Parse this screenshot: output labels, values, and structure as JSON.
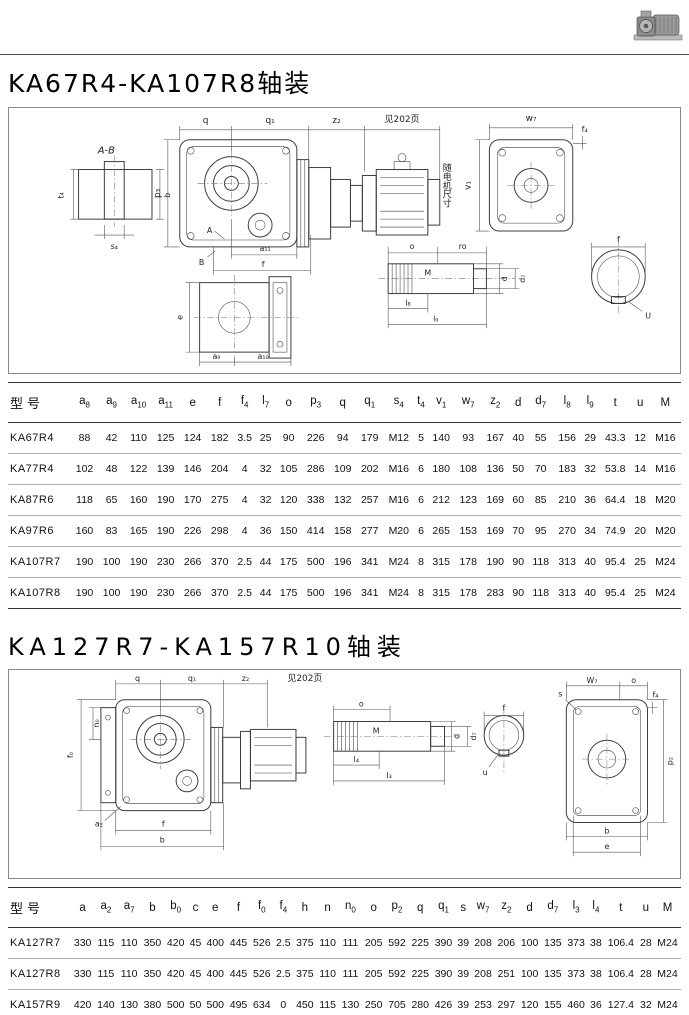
{
  "page": {
    "title1": "KA67R4-KA107R8轴装",
    "title2": "KA127R7-KA157R10轴装"
  },
  "figure1": {
    "labels": {
      "ab": "A-B",
      "t4": "t₄",
      "b": "b",
      "s4": "s₄",
      "q": "q",
      "q1": "q₁",
      "z2": "z₂",
      "see": "见202页",
      "p3": "p₃",
      "A": "A",
      "B": "B",
      "a11": "a₁₁",
      "f": "f",
      "motor_note": "随电机尺寸",
      "e": "e",
      "a9": "a₉",
      "a10": "a₁₀",
      "w7": "w₇",
      "f4": "f₄",
      "v1": "v₁",
      "o": "o",
      "ro": "ro",
      "M": "M",
      "d": "d",
      "d7": "d₇",
      "l8": "l₈",
      "l9": "l₉",
      "f_end": "f",
      "U": "U"
    }
  },
  "figure2": {
    "labels": {
      "q": "q",
      "q1": "q₁",
      "z2": "z₂",
      "see": "见202页",
      "f0": "f₀",
      "n0": "n₀",
      "a2": "a₂",
      "f": "f",
      "b": "b",
      "o": "o",
      "M": "M",
      "d": "d",
      "d7": "d₇",
      "l4": "l₄",
      "l3": "l₃",
      "f_end": "f",
      "u": "u",
      "W7": "W₇",
      "o2": "o",
      "s": "s",
      "f4": "f₄",
      "p2": "p₂",
      "b2": "b",
      "e": "e"
    }
  },
  "table1": {
    "headers": [
      "型号",
      "a_8",
      "a_9",
      "a_10",
      "a_11",
      "e",
      "f",
      "f_4",
      "l_7",
      "o",
      "p_3",
      "q",
      "q_1",
      "s_4",
      "t_4",
      "v_1",
      "w_7",
      "z_2",
      "d",
      "d_7",
      "l_8",
      "l_9",
      "t",
      "u",
      "M"
    ],
    "rows": [
      {
        "model": "KA67R4",
        "values": [
          "88",
          "42",
          "110",
          "125",
          "124",
          "182",
          "3.5",
          "25",
          "90",
          "226",
          "94",
          "179",
          "M12",
          "5",
          "140",
          "93",
          "167",
          "40",
          "55",
          "156",
          "29",
          "43.3",
          "12",
          "M16"
        ]
      },
      {
        "model": "KA77R4",
        "values": [
          "102",
          "48",
          "122",
          "139",
          "146",
          "204",
          "4",
          "32",
          "105",
          "286",
          "109",
          "202",
          "M16",
          "6",
          "180",
          "108",
          "136",
          "50",
          "70",
          "183",
          "32",
          "53.8",
          "14",
          "M16"
        ]
      },
      {
        "model": "KA87R6",
        "values": [
          "118",
          "65",
          "160",
          "190",
          "170",
          "275",
          "4",
          "32",
          "120",
          "338",
          "132",
          "257",
          "M16",
          "6",
          "212",
          "123",
          "169",
          "60",
          "85",
          "210",
          "36",
          "64.4",
          "18",
          "M20"
        ]
      },
      {
        "model": "KA97R6",
        "values": [
          "160",
          "83",
          "165",
          "190",
          "226",
          "298",
          "4",
          "36",
          "150",
          "414",
          "158",
          "277",
          "M20",
          "6",
          "265",
          "153",
          "169",
          "70",
          "95",
          "270",
          "34",
          "74.9",
          "20",
          "M20"
        ]
      },
      {
        "model": "KA107R7",
        "values": [
          "190",
          "100",
          "190",
          "230",
          "266",
          "370",
          "2.5",
          "44",
          "175",
          "500",
          "196",
          "341",
          "M24",
          "8",
          "315",
          "178",
          "190",
          "90",
          "118",
          "313",
          "40",
          "95.4",
          "25",
          "M24"
        ]
      },
      {
        "model": "KA107R8",
        "values": [
          "190",
          "100",
          "190",
          "230",
          "266",
          "370",
          "2.5",
          "44",
          "175",
          "500",
          "196",
          "341",
          "M24",
          "8",
          "315",
          "178",
          "283",
          "90",
          "118",
          "313",
          "40",
          "95.4",
          "25",
          "M24"
        ]
      }
    ]
  },
  "table2": {
    "headers": [
      "型号",
      "a",
      "a_2",
      "a_7",
      "b",
      "b_0",
      "c",
      "e",
      "f",
      "f_0",
      "f_4",
      "h",
      "n",
      "n_0",
      "o",
      "p_2",
      "q",
      "q_1",
      "s",
      "w_7",
      "z_2",
      "d",
      "d_7",
      "l_3",
      "l_4",
      "t",
      "u",
      "M"
    ],
    "rows": [
      {
        "model": "KA127R7",
        "values": [
          "330",
          "115",
          "110",
          "350",
          "420",
          "45",
          "400",
          "445",
          "526",
          "2.5",
          "375",
          "110",
          "111",
          "205",
          "592",
          "225",
          "390",
          "39",
          "208",
          "206",
          "100",
          "135",
          "373",
          "38",
          "106.4",
          "28",
          "M24"
        ]
      },
      {
        "model": "KA127R8",
        "values": [
          "330",
          "115",
          "110",
          "350",
          "420",
          "45",
          "400",
          "445",
          "526",
          "2.5",
          "375",
          "110",
          "111",
          "205",
          "592",
          "225",
          "390",
          "39",
          "208",
          "251",
          "100",
          "135",
          "373",
          "38",
          "106.4",
          "28",
          "M24"
        ]
      },
      {
        "model": "KA157R9",
        "values": [
          "420",
          "140",
          "130",
          "380",
          "500",
          "50",
          "500",
          "495",
          "634",
          "0",
          "450",
          "115",
          "130",
          "250",
          "705",
          "280",
          "426",
          "39",
          "253",
          "297",
          "120",
          "155",
          "460",
          "36",
          "127.4",
          "32",
          "M24"
        ]
      },
      {
        "model": "KA157R10",
        "values": [
          "420",
          "140",
          "130",
          "380",
          "500",
          "50",
          "500",
          "495",
          "634",
          "0",
          "450",
          "115",
          "130",
          "250",
          "705",
          "280",
          "426",
          "39",
          "253",
          "352",
          "120",
          "155",
          "460",
          "36",
          "127.4",
          "32",
          "M24"
        ]
      }
    ]
  }
}
